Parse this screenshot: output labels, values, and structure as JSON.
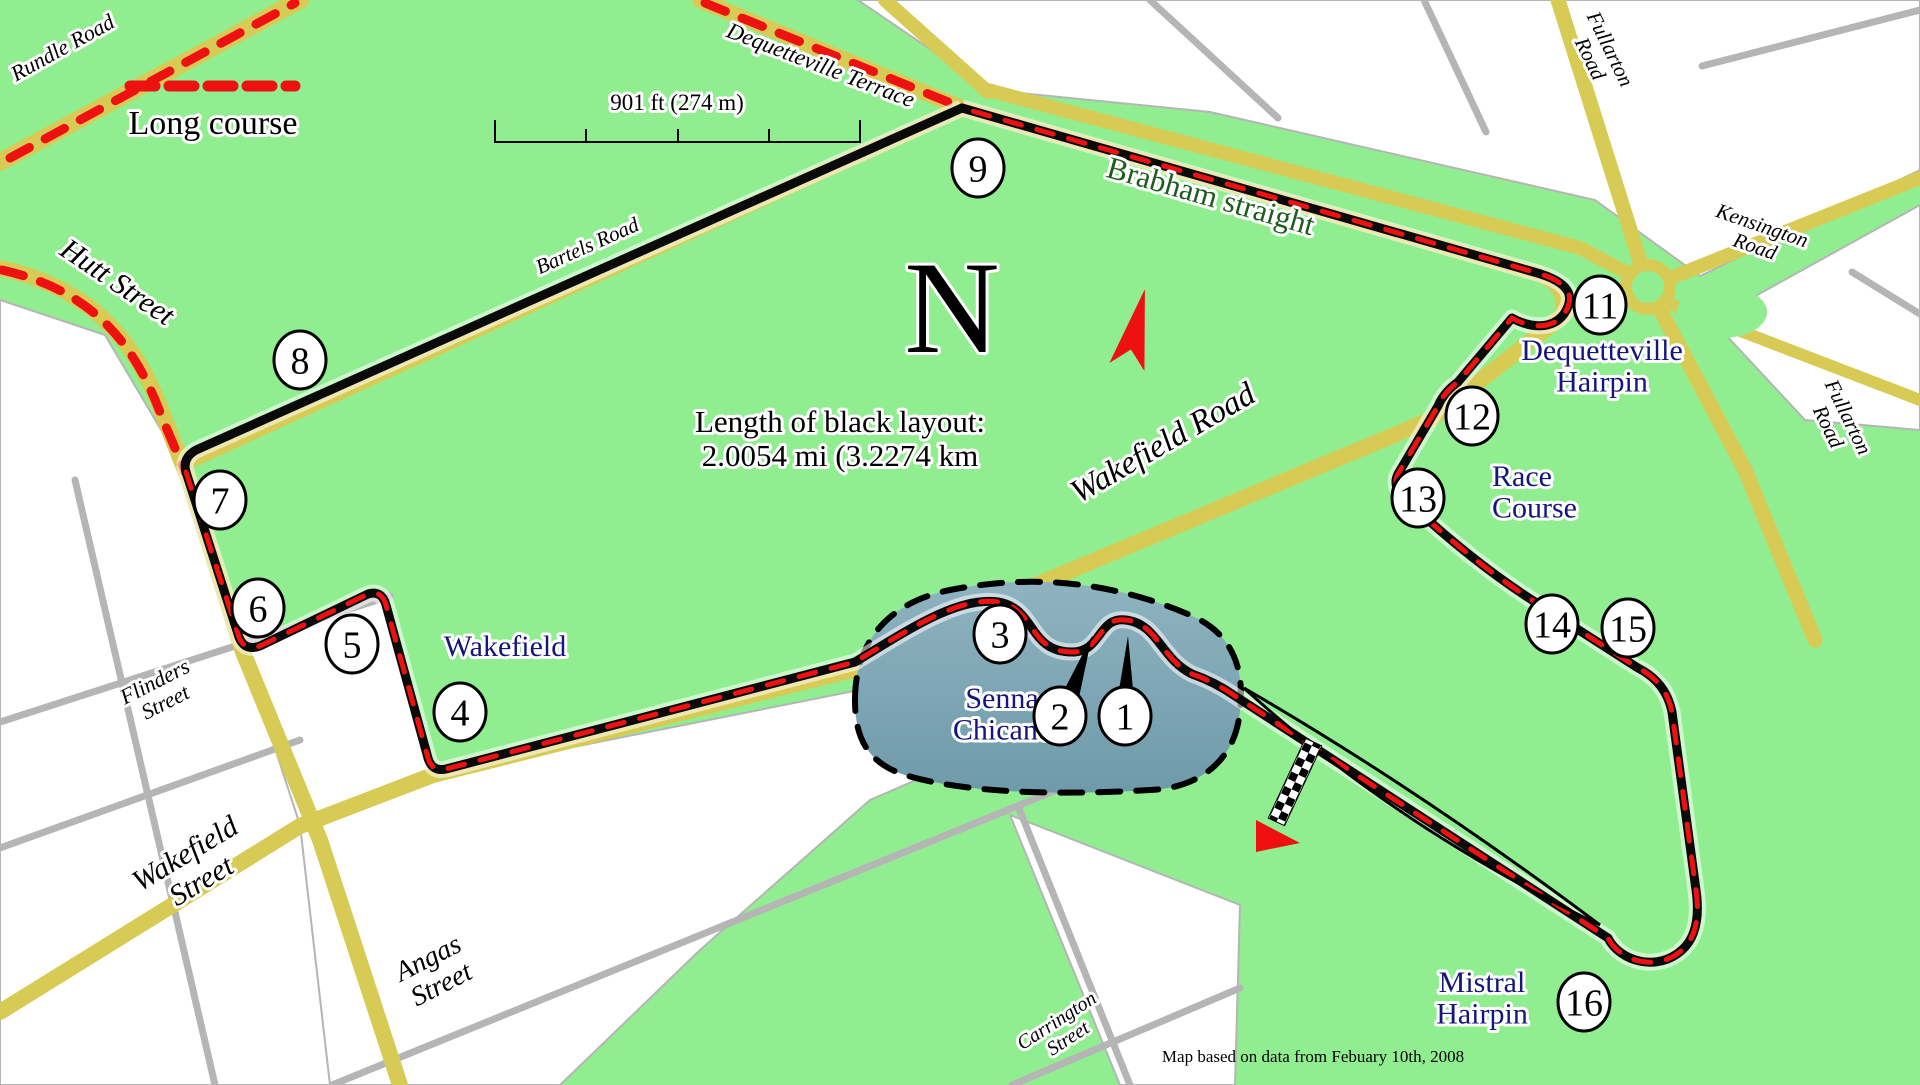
{
  "map": {
    "legend_label": "Long course",
    "scale_label": "901 ft (274 m)",
    "compass_letter": "N",
    "length_note_line1": "Length of black layout:",
    "length_note_line2": "2.0054 mi (3.2274 km",
    "attribution": "Map based on data from Febuary 10th, 2008"
  },
  "colors": {
    "park_green": "#90ee90",
    "road_yellow": "#d8cb55",
    "road_gray": "#b5b5b5",
    "track_black": "#0a0a0a",
    "course_red": "#ee1111",
    "label_navy": "#15157d",
    "label_dark_green": "#1d5c1d",
    "chicane_fill": "#7ea6b5"
  },
  "turns": [
    {
      "n": "1",
      "x": 1125,
      "y": 716
    },
    {
      "n": "2",
      "x": 1060,
      "y": 716
    },
    {
      "n": "3",
      "x": 1000,
      "y": 634
    },
    {
      "n": "4",
      "x": 460,
      "y": 712
    },
    {
      "n": "5",
      "x": 352,
      "y": 644
    },
    {
      "n": "6",
      "x": 258,
      "y": 608
    },
    {
      "n": "7",
      "x": 220,
      "y": 500
    },
    {
      "n": "8",
      "x": 300,
      "y": 360
    },
    {
      "n": "9",
      "x": 978,
      "y": 168
    },
    {
      "n": "11",
      "x": 1600,
      "y": 305
    },
    {
      "n": "12",
      "x": 1472,
      "y": 416
    },
    {
      "n": "13",
      "x": 1418,
      "y": 498
    },
    {
      "n": "14",
      "x": 1552,
      "y": 624
    },
    {
      "n": "15",
      "x": 1628,
      "y": 628
    },
    {
      "n": "16",
      "x": 1584,
      "y": 1002
    }
  ],
  "street_labels": [
    {
      "id": "rundle-road",
      "x": 66,
      "y": 54,
      "rot": -29,
      "size": 22,
      "lines": [
        "Rundle Road"
      ]
    },
    {
      "id": "dequetteville-terrace",
      "x": 818,
      "y": 72,
      "rot": 21,
      "size": 23,
      "lines": [
        "Dequetteville Terrace"
      ]
    },
    {
      "id": "hutt-street",
      "x": 112,
      "y": 290,
      "rot": 34,
      "size": 30,
      "lines": [
        "Hutt Street"
      ]
    },
    {
      "id": "bartels-road",
      "x": 590,
      "y": 252,
      "rot": -24,
      "size": 21,
      "lines": [
        "Bartels Road"
      ]
    },
    {
      "id": "wakefield-road",
      "x": 1168,
      "y": 452,
      "rot": -30,
      "size": 33,
      "lines": [
        "Wakefield Road"
      ]
    },
    {
      "id": "fullarton-road-top",
      "x": 1604,
      "y": 52,
      "rot": 64,
      "size": 21,
      "lines": [
        "Fullarton",
        "Road"
      ]
    },
    {
      "id": "kensington-road",
      "x": 1760,
      "y": 232,
      "rot": 19,
      "size": 21,
      "lines": [
        "Kensington",
        "Road"
      ]
    },
    {
      "id": "fullarton-road-right",
      "x": 1842,
      "y": 420,
      "rot": 64,
      "size": 21,
      "lines": [
        "Fullarton",
        "Road"
      ]
    },
    {
      "id": "flinders-street",
      "x": 158,
      "y": 688,
      "rot": -27,
      "size": 22,
      "lines": [
        "Flinders",
        "Street"
      ]
    },
    {
      "id": "wakefield-street",
      "x": 190,
      "y": 862,
      "rot": -31,
      "size": 30,
      "lines": [
        "Wakefield",
        "Street"
      ]
    },
    {
      "id": "angas-street",
      "x": 432,
      "y": 966,
      "rot": -27,
      "size": 28,
      "lines": [
        "Angas",
        "Street"
      ]
    },
    {
      "id": "carrington-street",
      "x": 1060,
      "y": 1026,
      "rot": -33,
      "size": 20,
      "lines": [
        "Carrington",
        "Street"
      ]
    },
    {
      "id": "brabham-straight",
      "x": 1208,
      "y": 206,
      "rot": 16,
      "size": 31,
      "lines": [
        "Brabham straight"
      ],
      "cls": "green"
    }
  ],
  "corner_labels": [
    {
      "id": "dequetteville-hairpin",
      "x": 1602,
      "y": 360,
      "size": 30,
      "anchor": "middle",
      "lines": [
        "Dequetteville",
        "Hairpin"
      ]
    },
    {
      "id": "race-course",
      "x": 1492,
      "y": 486,
      "size": 30,
      "anchor": "start",
      "lines": [
        "Race",
        "Course"
      ]
    },
    {
      "id": "wakefield-corner",
      "x": 505,
      "y": 656,
      "size": 30,
      "anchor": "middle",
      "lines": [
        "Wakefield"
      ]
    },
    {
      "id": "senna-chicane",
      "x": 1002,
      "y": 708,
      "size": 30,
      "anchor": "middle",
      "lines": [
        "Senna",
        "Chicane"
      ]
    },
    {
      "id": "mistral-hairpin",
      "x": 1482,
      "y": 992,
      "size": 30,
      "anchor": "middle",
      "lines": [
        "Mistral",
        "Hairpin"
      ]
    }
  ]
}
